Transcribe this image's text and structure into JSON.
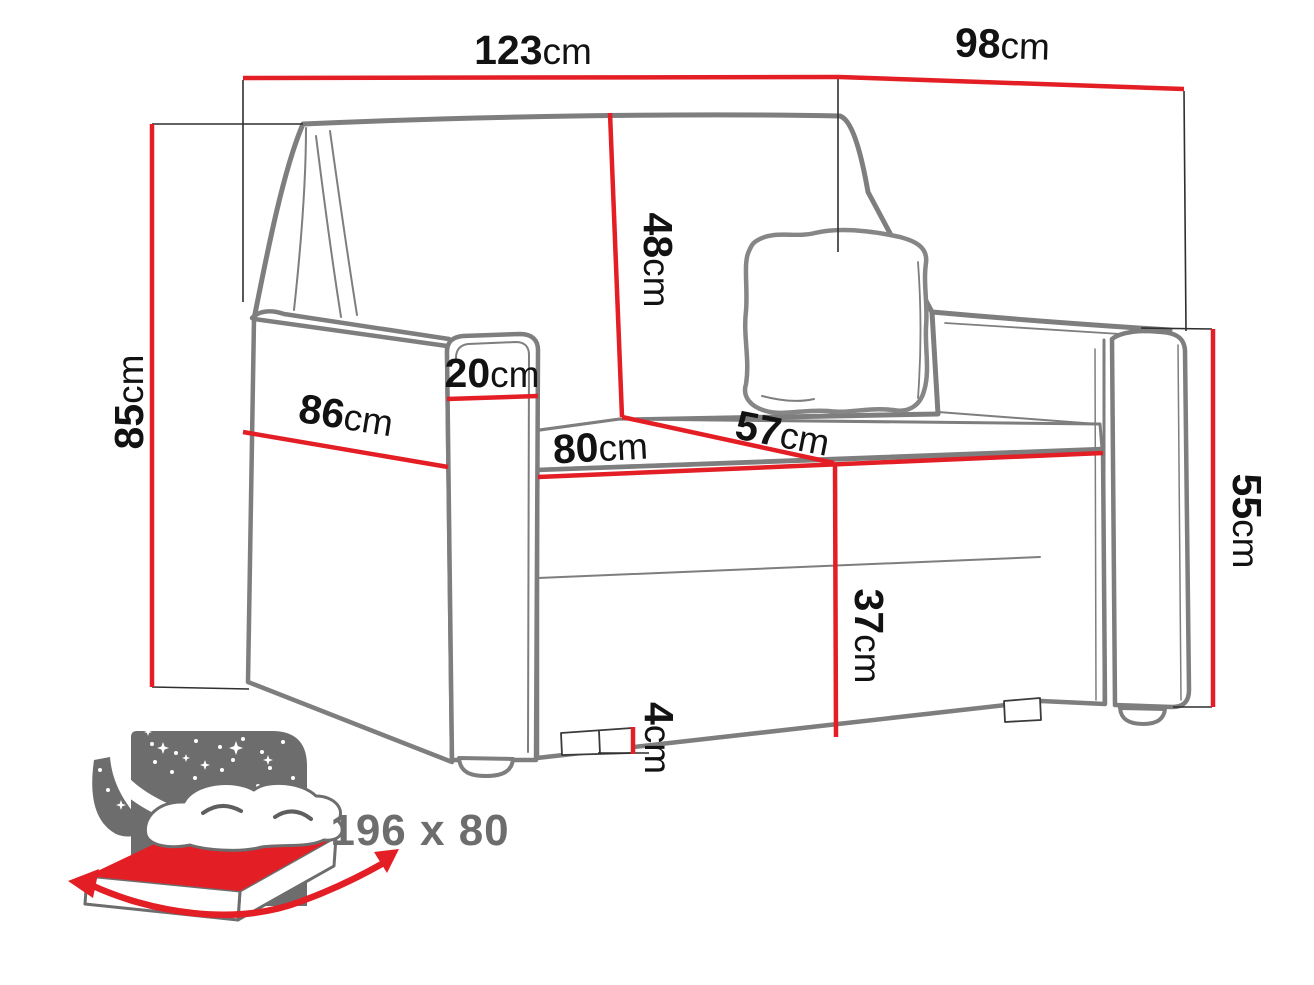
{
  "dimensions": {
    "total_width": {
      "value": "123",
      "unit": "cm"
    },
    "total_depth": {
      "value": "98",
      "unit": "cm"
    },
    "total_height": {
      "value": "85",
      "unit": "cm"
    },
    "backrest_height": {
      "value": "48",
      "unit": "cm"
    },
    "armrest_width": {
      "value": "20",
      "unit": "cm"
    },
    "side_depth": {
      "value": "86",
      "unit": "cm"
    },
    "seat_width": {
      "value": "80",
      "unit": "cm"
    },
    "seat_depth": {
      "value": "57",
      "unit": "cm"
    },
    "armrest_height": {
      "value": "55",
      "unit": "cm"
    },
    "seat_height": {
      "value": "37",
      "unit": "cm"
    },
    "leg_height": {
      "value": "4",
      "unit": "cm"
    }
  },
  "sleeping_area": {
    "label": "196 x 80"
  },
  "icons": {
    "sleep_function_icon": "fold-out-bed-night-stars-icon"
  },
  "colors": {
    "dimension_red": "#e31e24",
    "sketch_gray": "#7e7e7e",
    "icon_gray": "#6d6d6d",
    "text_black": "#121212"
  }
}
